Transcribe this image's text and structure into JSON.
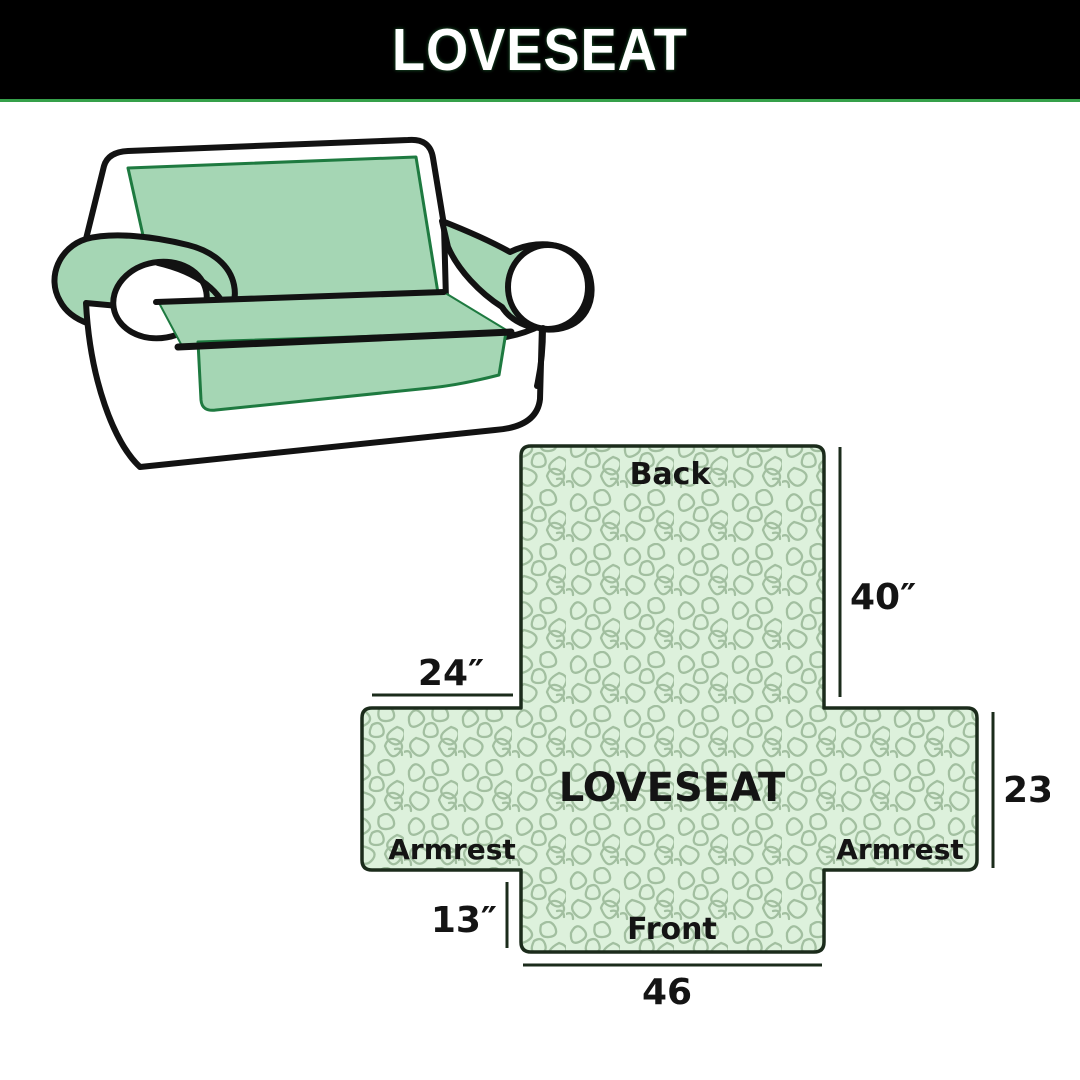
{
  "header": {
    "title": "LOVESEAT",
    "bg_color": "#000000",
    "text_color": "#ffffff",
    "accent_line_color": "#35a04a"
  },
  "sofa": {
    "cover_color": "#a5d6b4",
    "outline_color": "#121212",
    "seam_color": "#1e7a40",
    "body_color": "#ffffff"
  },
  "diagram": {
    "center_label": "LOVESEAT",
    "back_label": "Back",
    "front_label": "Front",
    "armrest_left_label": "Armrest",
    "armrest_right_label": "Armrest",
    "dim_back_height": "40″",
    "dim_armrest_top_width": "24″",
    "dim_armrest_side_height": "23″",
    "dim_front_height": "13″",
    "dim_front_width": "46",
    "fill_color": "#ddf1dc",
    "pattern_line_color": "#a2bfa0",
    "outline_color": "#1b2b1b",
    "text_color": "#141414"
  }
}
